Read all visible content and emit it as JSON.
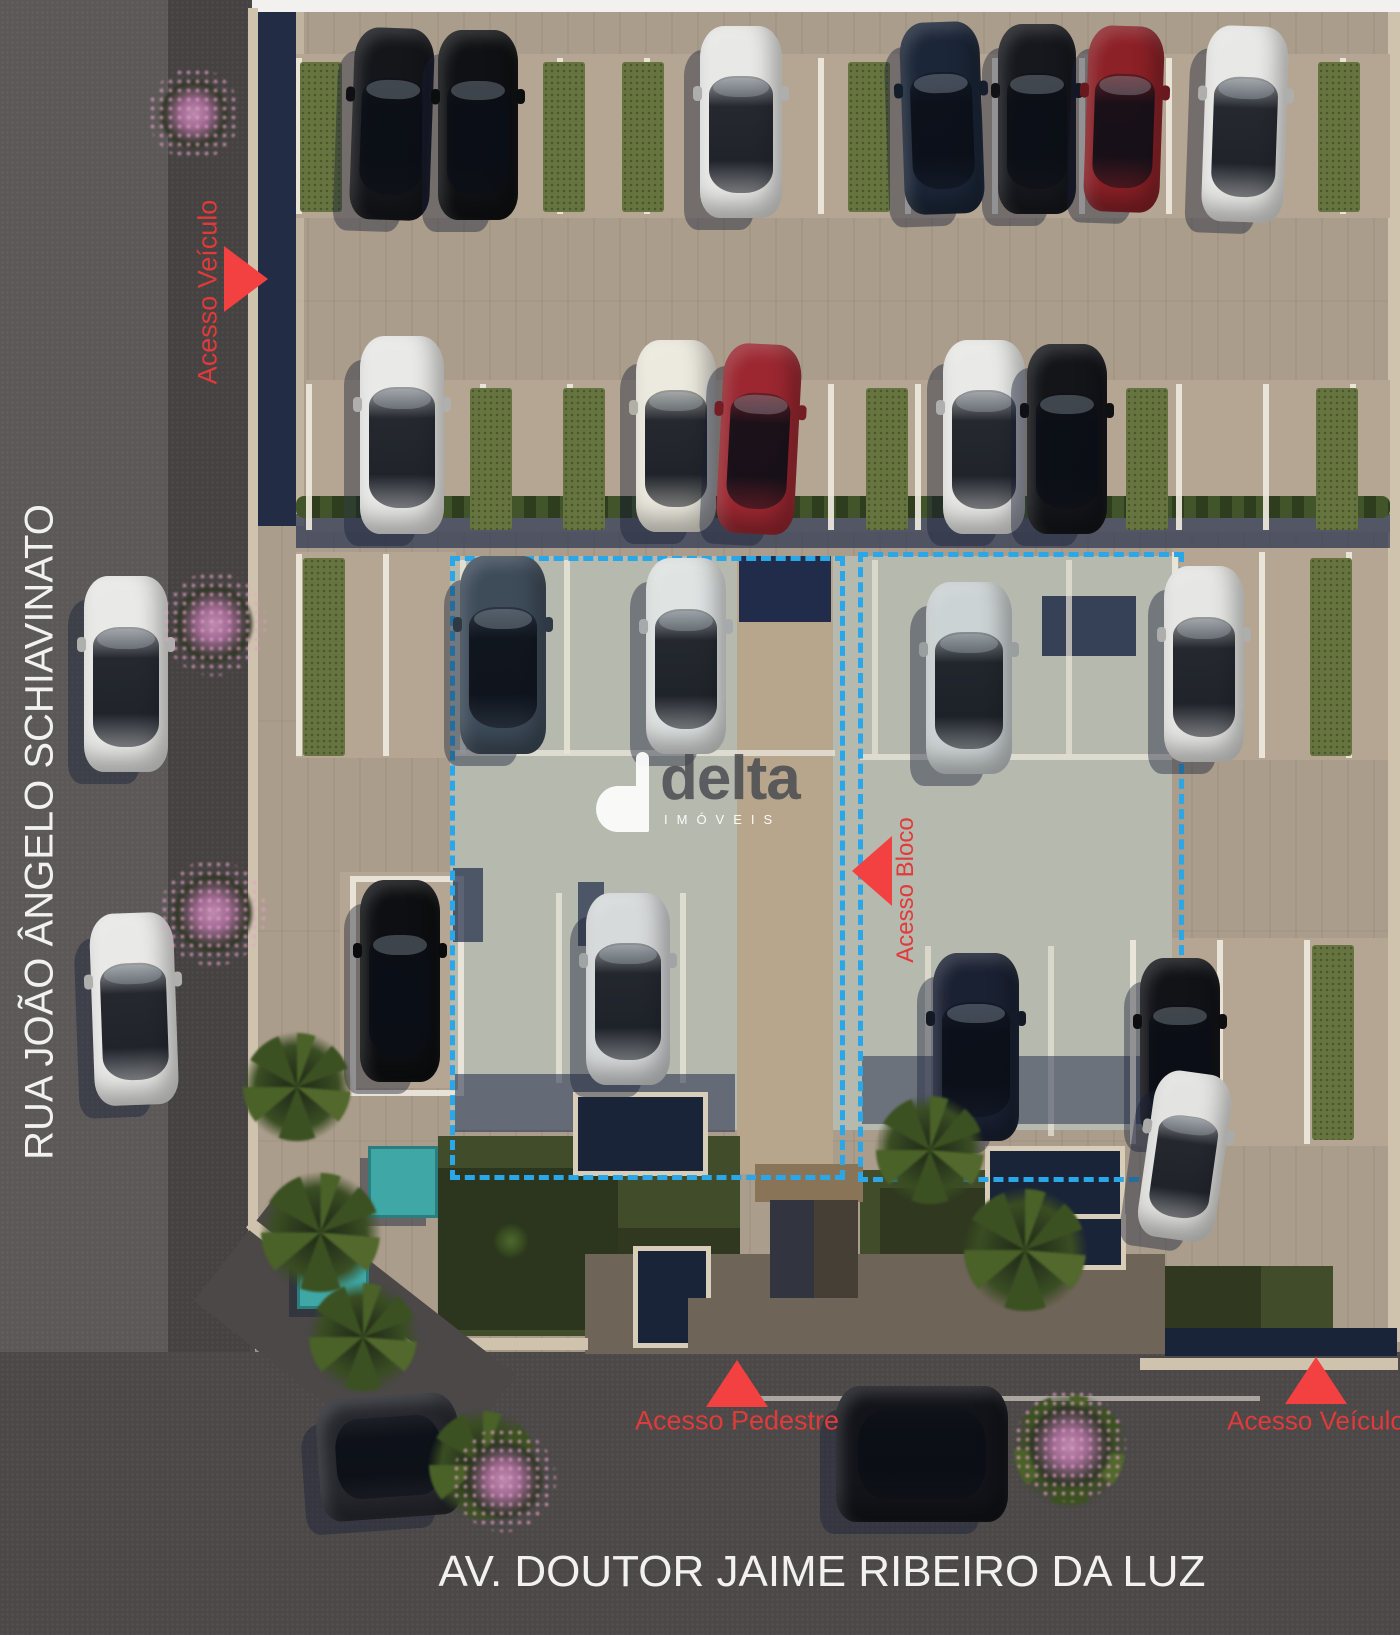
{
  "streets": {
    "left_name": "RUA JOÃO ÂNGELO SCHIAVINATO",
    "bottom_name": "AV. DOUTOR JAIME RIBEIRO DA LUZ"
  },
  "access": {
    "top_left": {
      "label": "Acesso Veículo",
      "direction": "right"
    },
    "block": {
      "label": "Acesso Bloco",
      "direction": "left"
    },
    "pedestrian": {
      "label": "Acesso Pedestre",
      "direction": "up"
    },
    "bottom_right": {
      "label": "Acesso Veículo",
      "direction": "up"
    }
  },
  "watermark": {
    "brand": "delta",
    "subtitle": "IMÓVEIS"
  },
  "palette": {
    "accent_dash": "#2aa7e8",
    "accent_red": "#f34040",
    "red_text": "#e03a3a",
    "asphalt": "#4b4847",
    "pavement": "#ab9d8c",
    "building_pad": "#b6b9ae",
    "grass": "#66743f",
    "navy_shadow": "#202c49",
    "teal": "#3fa8a6",
    "curb": "#cfc3ae",
    "white_text": "#f2f1ee"
  },
  "render": {
    "dashed_zones": [
      {
        "x": 450,
        "y": 556,
        "w": 385,
        "h": 614
      },
      {
        "x": 858,
        "y": 552,
        "w": 316,
        "h": 620
      }
    ],
    "rects": [
      {
        "x": 252,
        "y": 0,
        "w": 1148,
        "h": 12,
        "fill": "#f2f1ef"
      },
      {
        "x": 1388,
        "y": 12,
        "w": 12,
        "h": 1330,
        "fill": "#cfc3ae"
      },
      {
        "x": 248,
        "y": 8,
        "w": 10,
        "h": 1242,
        "fill": "#cfc3ae"
      },
      {
        "x": 258,
        "y": 12,
        "w": 38,
        "h": 514,
        "fill": "#222d45"
      },
      {
        "x": 296,
        "y": 12,
        "w": 8,
        "h": 514,
        "fill": "#c9bda7",
        "op": 0.7
      },
      {
        "x": 296,
        "y": 54,
        "w": 1094,
        "h": 164,
        "fill": "#b5a693",
        "cls": "plank"
      },
      {
        "x": 306,
        "y": 380,
        "w": 1084,
        "h": 152,
        "fill": "#b5a693",
        "cls": "plank"
      },
      {
        "x": 296,
        "y": 552,
        "w": 160,
        "h": 206,
        "fill": "#b5a693",
        "cls": "plank"
      },
      {
        "x": 1172,
        "y": 548,
        "w": 216,
        "h": 212,
        "fill": "#b5a693",
        "cls": "plank"
      },
      {
        "x": 340,
        "y": 872,
        "w": 120,
        "h": 216,
        "fill": "#b5a693",
        "cls": "plank"
      },
      {
        "x": 1130,
        "y": 938,
        "w": 258,
        "h": 208,
        "fill": "#b5a693",
        "cls": "plank"
      },
      {
        "x": 296,
        "y": 514,
        "w": 1094,
        "h": 34,
        "fill": "#2a3550",
        "op": 0.7
      },
      {
        "x": 296,
        "y": 496,
        "w": 1094,
        "h": 22,
        "cls": "hedge"
      },
      {
        "x": 450,
        "y": 556,
        "w": 722,
        "h": 574,
        "fill": "#b6b9ae",
        "cls": "plankv"
      },
      {
        "x": 737,
        "y": 556,
        "w": 96,
        "h": 618,
        "fill": "#b7a68c",
        "cls": "plankv"
      },
      {
        "x": 739,
        "y": 556,
        "w": 92,
        "h": 66,
        "fill": "#202c49"
      },
      {
        "x": 1042,
        "y": 596,
        "w": 94,
        "h": 60,
        "fill": "#202c49",
        "op": 0.85
      },
      {
        "x": 460,
        "y": 560,
        "w": 6,
        "h": 194,
        "fill": "#e9e4d8",
        "op": 0.85
      },
      {
        "x": 564,
        "y": 560,
        "w": 6,
        "h": 194,
        "fill": "#e9e4d8",
        "op": 0.85
      },
      {
        "x": 666,
        "y": 560,
        "w": 6,
        "h": 194,
        "fill": "#e9e4d8",
        "op": 0.85
      },
      {
        "x": 872,
        "y": 560,
        "w": 6,
        "h": 194,
        "fill": "#e9e4d8",
        "op": 0.7
      },
      {
        "x": 1066,
        "y": 560,
        "w": 6,
        "h": 194,
        "fill": "#e9e4d8",
        "op": 0.7
      },
      {
        "x": 452,
        "y": 750,
        "w": 383,
        "h": 6,
        "fill": "#e9e4d8",
        "op": 0.8
      },
      {
        "x": 860,
        "y": 754,
        "w": 312,
        "h": 6,
        "fill": "#e9e4d8",
        "op": 0.8
      },
      {
        "x": 556,
        "y": 893,
        "w": 6,
        "h": 190,
        "fill": "#e9e4d8",
        "op": 0.8
      },
      {
        "x": 680,
        "y": 893,
        "w": 6,
        "h": 190,
        "fill": "#e9e4d8",
        "op": 0.8
      },
      {
        "x": 925,
        "y": 946,
        "w": 6,
        "h": 190,
        "fill": "#e9e4d8",
        "op": 0.7
      },
      {
        "x": 1048,
        "y": 946,
        "w": 6,
        "h": 190,
        "fill": "#e9e4d8",
        "op": 0.7
      },
      {
        "x": 350,
        "y": 876,
        "w": 102,
        "h": 208,
        "cls": "stallbox"
      },
      {
        "x": 453,
        "y": 868,
        "w": 30,
        "h": 74,
        "fill": "#202c49",
        "op": 0.7
      },
      {
        "x": 578,
        "y": 882,
        "w": 26,
        "h": 64,
        "fill": "#202c49",
        "op": 0.7
      },
      {
        "x": 455,
        "y": 1074,
        "w": 280,
        "h": 58,
        "fill": "#202c49",
        "op": 0.55
      },
      {
        "x": 862,
        "y": 1056,
        "w": 298,
        "h": 68,
        "fill": "#202c49",
        "op": 0.5
      },
      {
        "x": 438,
        "y": 1136,
        "w": 302,
        "h": 200,
        "fill": "#414c2a",
        "cls": "speck"
      },
      {
        "x": 438,
        "y": 1168,
        "w": 180,
        "h": 162,
        "fill": "#1c2414",
        "op": 0.55
      },
      {
        "x": 618,
        "y": 1228,
        "w": 122,
        "h": 106,
        "fill": "#1c2414",
        "op": 0.45
      },
      {
        "x": 860,
        "y": 1170,
        "w": 128,
        "h": 90,
        "fill": "#414c2a",
        "cls": "speck"
      },
      {
        "x": 880,
        "y": 1188,
        "w": 108,
        "h": 72,
        "fill": "#1c2414",
        "op": 0.45
      },
      {
        "x": 585,
        "y": 1254,
        "w": 580,
        "h": 100,
        "fill": "#6f6458"
      },
      {
        "x": 1165,
        "y": 1266,
        "w": 168,
        "h": 82,
        "fill": "#414c2a",
        "cls": "speck"
      },
      {
        "x": 1165,
        "y": 1266,
        "w": 96,
        "h": 82,
        "fill": "#1c2414",
        "op": 0.45
      },
      {
        "x": 573,
        "y": 1092,
        "w": 125,
        "h": 74,
        "cls": "fbox"
      },
      {
        "x": 633,
        "y": 1246,
        "w": 68,
        "h": 92,
        "cls": "fbox"
      },
      {
        "x": 985,
        "y": 1146,
        "w": 130,
        "h": 64,
        "cls": "fbox"
      },
      {
        "x": 990,
        "y": 1214,
        "w": 126,
        "h": 46,
        "cls": "fbox"
      },
      {
        "x": 755,
        "y": 1164,
        "w": 108,
        "h": 38,
        "fill": "#8a7457"
      },
      {
        "x": 770,
        "y": 1200,
        "w": 88,
        "h": 152,
        "fill": "#453f35"
      },
      {
        "x": 770,
        "y": 1200,
        "w": 44,
        "h": 152,
        "fill": "#202c49",
        "op": 0.5
      },
      {
        "x": 688,
        "y": 1298,
        "w": 272,
        "h": 56,
        "fill": "#6f6458"
      },
      {
        "x": 255,
        "y": 1338,
        "w": 333,
        "h": 12,
        "fill": "#cfc3ae"
      },
      {
        "x": 1165,
        "y": 1328,
        "w": 232,
        "h": 28,
        "fill": "#1a2438"
      },
      {
        "x": 1140,
        "y": 1358,
        "w": 258,
        "h": 12,
        "fill": "#cfc3ae"
      },
      {
        "x": 205,
        "y": 1268,
        "w": 300,
        "h": 140,
        "fill": "#4b4847",
        "rot": 38
      },
      {
        "x": 228,
        "y": 1280,
        "w": 205,
        "h": 12,
        "fill": "#cfc3ae",
        "rot": 38
      },
      {
        "x": 740,
        "y": 1396,
        "w": 520,
        "h": 5,
        "fill": "#e9e4d8",
        "op": 0.6
      },
      {
        "x": 368,
        "y": 1146,
        "w": 64,
        "h": 66,
        "cls": "teal"
      },
      {
        "x": 297,
        "y": 1235,
        "w": 66,
        "h": 68,
        "cls": "teal"
      }
    ],
    "stall_rows": [
      {
        "x": 296,
        "y": 58,
        "w": 1094,
        "h": 156
      },
      {
        "x": 306,
        "y": 384,
        "w": 1084,
        "h": 146
      },
      {
        "x": 296,
        "y": 554,
        "w": 160,
        "h": 202
      },
      {
        "x": 1172,
        "y": 552,
        "w": 216,
        "h": 206
      },
      {
        "x": 1130,
        "y": 940,
        "w": 258,
        "h": 204
      }
    ],
    "grass_strips": [
      {
        "x": 300,
        "y": 62,
        "w": 42,
        "h": 150
      },
      {
        "x": 543,
        "y": 62,
        "w": 42,
        "h": 150
      },
      {
        "x": 622,
        "y": 62,
        "w": 42,
        "h": 150
      },
      {
        "x": 848,
        "y": 62,
        "w": 42,
        "h": 150
      },
      {
        "x": 1318,
        "y": 62,
        "w": 42,
        "h": 150
      },
      {
        "x": 470,
        "y": 388,
        "w": 42,
        "h": 142
      },
      {
        "x": 563,
        "y": 388,
        "w": 42,
        "h": 142
      },
      {
        "x": 866,
        "y": 388,
        "w": 42,
        "h": 142
      },
      {
        "x": 1126,
        "y": 388,
        "w": 42,
        "h": 142
      },
      {
        "x": 1316,
        "y": 388,
        "w": 42,
        "h": 142
      },
      {
        "x": 303,
        "y": 558,
        "w": 42,
        "h": 198
      },
      {
        "x": 1310,
        "y": 558,
        "w": 42,
        "h": 198
      },
      {
        "x": 1312,
        "y": 945,
        "w": 42,
        "h": 195
      }
    ],
    "cars": [
      {
        "x": 352,
        "y": 28,
        "w": 80,
        "h": 192,
        "c": "#15161a",
        "r": 2
      },
      {
        "x": 438,
        "y": 30,
        "w": 80,
        "h": 190,
        "c": "#101114",
        "r": 0
      },
      {
        "x": 700,
        "y": 26,
        "w": 82,
        "h": 192,
        "c": "#e8e8e6",
        "r": 0
      },
      {
        "x": 902,
        "y": 22,
        "w": 80,
        "h": 192,
        "c": "#1b2638",
        "r": -2
      },
      {
        "x": 998,
        "y": 24,
        "w": 78,
        "h": 190,
        "c": "#17181d",
        "r": 0
      },
      {
        "x": 1086,
        "y": 26,
        "w": 76,
        "h": 186,
        "c": "#8c2127",
        "r": 2
      },
      {
        "x": 1204,
        "y": 26,
        "w": 82,
        "h": 196,
        "c": "#e8e8e6",
        "r": 2
      },
      {
        "x": 360,
        "y": 336,
        "w": 84,
        "h": 198,
        "c": "#e9e9e7",
        "r": 0
      },
      {
        "x": 636,
        "y": 340,
        "w": 80,
        "h": 192,
        "c": "#eceade",
        "r": 0
      },
      {
        "x": 720,
        "y": 344,
        "w": 78,
        "h": 190,
        "c": "#9c2730",
        "r": 3
      },
      {
        "x": 943,
        "y": 340,
        "w": 82,
        "h": 194,
        "c": "#e9e9e7",
        "r": 0
      },
      {
        "x": 1027,
        "y": 344,
        "w": 80,
        "h": 190,
        "c": "#141519",
        "r": 0
      },
      {
        "x": 460,
        "y": 556,
        "w": 86,
        "h": 198,
        "c": "#3e4c5a",
        "r": 0
      },
      {
        "x": 646,
        "y": 558,
        "w": 80,
        "h": 196,
        "c": "#dfe3e2",
        "r": 0
      },
      {
        "x": 926,
        "y": 582,
        "w": 86,
        "h": 192,
        "c": "#ccd3d4",
        "r": 0
      },
      {
        "x": 1164,
        "y": 566,
        "w": 80,
        "h": 196,
        "c": "#e6e6e4",
        "r": 0
      },
      {
        "x": 84,
        "y": 576,
        "w": 84,
        "h": 196,
        "c": "#e9e9e7",
        "r": 0
      },
      {
        "x": 92,
        "y": 913,
        "w": 84,
        "h": 192,
        "c": "#e9e9e7",
        "r": -2
      },
      {
        "x": 360,
        "y": 880,
        "w": 80,
        "h": 202,
        "c": "#0e0f12",
        "r": 0
      },
      {
        "x": 586,
        "y": 893,
        "w": 84,
        "h": 192,
        "c": "#d7dadb",
        "r": 0
      },
      {
        "x": 933,
        "y": 953,
        "w": 86,
        "h": 188,
        "c": "#1a2133",
        "r": 0
      },
      {
        "x": 1140,
        "y": 958,
        "w": 80,
        "h": 182,
        "c": "#121317",
        "r": 0
      },
      {
        "x": 1146,
        "y": 1072,
        "w": 78,
        "h": 168,
        "c": "#e3e3e1",
        "r": 8
      },
      {
        "x": 318,
        "y": 1396,
        "w": 142,
        "h": 122,
        "c": "#26282e",
        "r": -4,
        "h_orient": true
      },
      {
        "x": 836,
        "y": 1386,
        "w": 172,
        "h": 136,
        "c": "#131419",
        "r": 0,
        "h_orient": true
      }
    ],
    "vegetation": [
      {
        "t": "pink",
        "x": 148,
        "y": 68,
        "s": 92
      },
      {
        "t": "pink",
        "x": 162,
        "y": 572,
        "s": 104
      },
      {
        "t": "pink",
        "x": 160,
        "y": 860,
        "s": 106
      },
      {
        "t": "palm",
        "x": 222,
        "y": 1012,
        "s": 150
      },
      {
        "t": "palm",
        "x": 238,
        "y": 1150,
        "s": 165
      },
      {
        "t": "palm",
        "x": 288,
        "y": 1262,
        "s": 150
      },
      {
        "t": "palm",
        "x": 855,
        "y": 1075,
        "s": 150
      },
      {
        "t": "palm",
        "x": 940,
        "y": 1165,
        "s": 170
      },
      {
        "t": "palm",
        "x": 408,
        "y": 1390,
        "s": 150
      },
      {
        "t": "pink",
        "x": 452,
        "y": 1428,
        "s": 104
      },
      {
        "t": "palm",
        "x": 992,
        "y": 1372,
        "s": 155
      },
      {
        "t": "pink",
        "x": 1014,
        "y": 1390,
        "s": 112
      },
      {
        "t": "green",
        "x": 488,
        "y": 1218,
        "s": 46
      }
    ]
  }
}
